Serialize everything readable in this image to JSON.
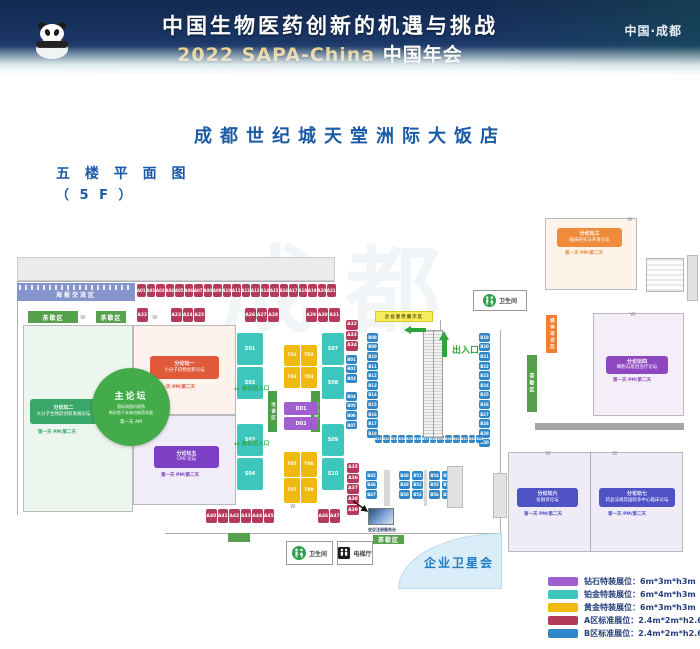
{
  "banner": {
    "title": "中国生物医药创新的机遇与挑战",
    "subtitle_en": "2022 SAPA-China",
    "subtitle_cn": "中国年会",
    "location": "中国·成都"
  },
  "page": {
    "hotel_title": "成都世纪城天堂洲际大饭店",
    "floor_label": "五 楼 平 面 图",
    "floor_sub": "（ 5 F ）",
    "watermark": "成都"
  },
  "labels": {
    "poster_area": "海报交流区",
    "tea_break": "茶歇区",
    "promo_area": "企业宣传展示区",
    "hall_entrance": "会议区入口",
    "exit": "出入口",
    "restroom": "卫生间",
    "elevator": "电梯厅",
    "satellite_meeting": "企业卫星会",
    "registration_caption": "会议注册服务台",
    "media_strip": "媒体采访区",
    "lounge_strip": "洽谈区",
    "arrow_glyph": "↔"
  },
  "main_forum": {
    "title": "主论坛",
    "line1": "国际和国内视角",
    "line2": "新形势下未来创新药发展",
    "time": "第一天 AM"
  },
  "forums": {
    "f1": {
      "tag": "分论坛一",
      "name": "小分子药物创新论坛",
      "caption": "第一天 PM/第二天"
    },
    "f2": {
      "tag": "分论坛二",
      "name": "大分子生物药创新发展论坛",
      "caption": "第一天 PM/第二天"
    },
    "f3": {
      "tag": "分论坛三",
      "name": "临床研究与开发论坛",
      "caption": "第一天 PM/第二天"
    },
    "f4": {
      "tag": "分论坛四",
      "name": "细胞与基因治疗论坛",
      "caption": "第一天 PM/第二天"
    },
    "f5": {
      "tag": "分论坛五",
      "name": "CMC论坛",
      "caption": "第一天 PM/第二天"
    },
    "f6": {
      "tag": "分论坛六",
      "name": "投融资论坛",
      "caption": "第一天 PM/第二天"
    },
    "f7": {
      "tag": "分论坛七",
      "name": "药品法规及国际多中心临床论坛",
      "caption": "第一天 PM/第二天"
    }
  },
  "booths": {
    "a_top": [
      "A01",
      "A02",
      "A03",
      "A04",
      "A05",
      "A06",
      "A07",
      "A08",
      "A09",
      "A10",
      "A11",
      "A12",
      "A13",
      "A14",
      "A15",
      "A16",
      "A17",
      "A18",
      "A19",
      "A20",
      "A21"
    ],
    "a_row2": {
      "single": [
        "A22"
      ],
      "g1": [
        "A23",
        "A24",
        "A25"
      ],
      "g2": [
        "A26",
        "A27",
        "A28"
      ],
      "g3": [
        "A29",
        "A30",
        "A31"
      ]
    },
    "a_col_top": [
      "A32",
      "A33",
      "A34"
    ],
    "a_col_bottom": [
      "A35",
      "A36",
      "A37",
      "A38",
      "A39"
    ],
    "a_bottom_left": [
      "A40",
      "A41",
      "A42",
      "A43",
      "A44",
      "A45"
    ],
    "a_bottom_right": [
      "A46",
      "A47"
    ],
    "b_col1_top": [
      "B01",
      "B02",
      "B03"
    ],
    "b_col1_bottom": [
      "B04",
      "B05",
      "B06",
      "B07"
    ],
    "b_esc_left": [
      "B08",
      "B09",
      "B10",
      "B11",
      "B12",
      "B13",
      "B14",
      "B15",
      "B16",
      "B17",
      "B18"
    ],
    "b_esc_right": [
      "B19",
      "B20",
      "B21",
      "B22",
      "B23",
      "B24",
      "B25",
      "B26",
      "B27",
      "B28",
      "B29",
      "B30"
    ],
    "b_bottom_row": [
      "B31",
      "B32",
      "B33",
      "B34",
      "B35",
      "B36",
      "B37",
      "B38",
      "B39",
      "B40",
      "B41",
      "B42",
      "B43",
      "B44"
    ],
    "b_south": {
      "c1": [
        "B45",
        "B46",
        "B47"
      ],
      "c2": [
        "B48",
        "B49",
        "B50"
      ],
      "c3": [
        "B51",
        "B52",
        "B53"
      ],
      "c4": [
        "B54",
        "B55",
        "B56"
      ],
      "c5": [
        "B57",
        "B58",
        "B59"
      ]
    },
    "s_left_top": [
      "S01",
      "S02"
    ],
    "s_left_bottom": [
      "S03",
      "S04"
    ],
    "s_right_top": [
      "S07",
      "S08"
    ],
    "s_right_bottom": [
      "S09",
      "S10"
    ],
    "t_top": [
      "T01",
      "T02",
      "T03",
      "T04"
    ],
    "t_bottom": [
      "T05",
      "T06",
      "T07",
      "T08"
    ],
    "d_col": [
      "D01",
      "D02"
    ]
  },
  "legend": {
    "items": [
      {
        "color": "#9f5fd0",
        "label": "钻石特装展位：",
        "size": "6m*3m*h3m"
      },
      {
        "color": "#3dc6be",
        "label": "铂金特装展位：",
        "size": "6m*4m*h3m"
      },
      {
        "color": "#f0b90f",
        "label": "黄金特装展位：",
        "size": "6m*3m*h3m"
      },
      {
        "color": "#b43a5c",
        "label": "A区标准展位：",
        "size": "2.4m*2m*h2.6m"
      },
      {
        "color": "#2e87c8",
        "label": "B区标准展位：",
        "size": "2.4m*2m*h2.6m"
      }
    ]
  }
}
